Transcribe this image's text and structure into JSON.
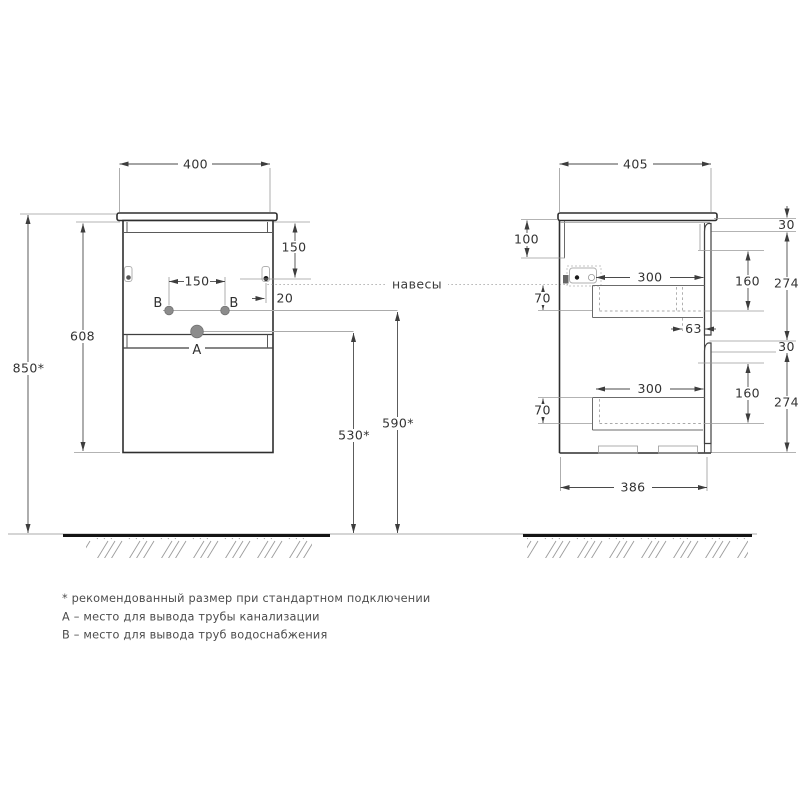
{
  "front_view": {
    "dim_width": "400",
    "dim_height": "608",
    "dim_mount_height": "850*",
    "dim_hinge_from_top": "150",
    "dim_water_spacing": "150",
    "dim_hinge_inset": "20",
    "dim_drain_from_floor": "530*",
    "dim_water_from_floor": "590*",
    "label_drain": "A",
    "label_water_left": "B",
    "label_water_right": "B"
  },
  "side_view": {
    "dim_depth": "405",
    "dim_back_rail": "100",
    "dim_front_top_gap": "30",
    "dim_front_panel_height": "274",
    "dim_inner_height": "160",
    "dim_drawer_depth": "300",
    "dim_drawer_height": "70",
    "dim_drawer_clearance": "63",
    "dim_bottom_depth": "386"
  },
  "annotations": {
    "hinges_label": "навесы"
  },
  "footnotes": [
    "* рекомендованный размер при стандартном подключении",
    "A – место для вывода трубы канализации",
    "B – место для вывода труб водоснабжения"
  ],
  "colors": {
    "outline": "#2e2e2e",
    "dimension": "#3d3d3d",
    "muted": "#9a9a9a",
    "background": "#ffffff"
  }
}
